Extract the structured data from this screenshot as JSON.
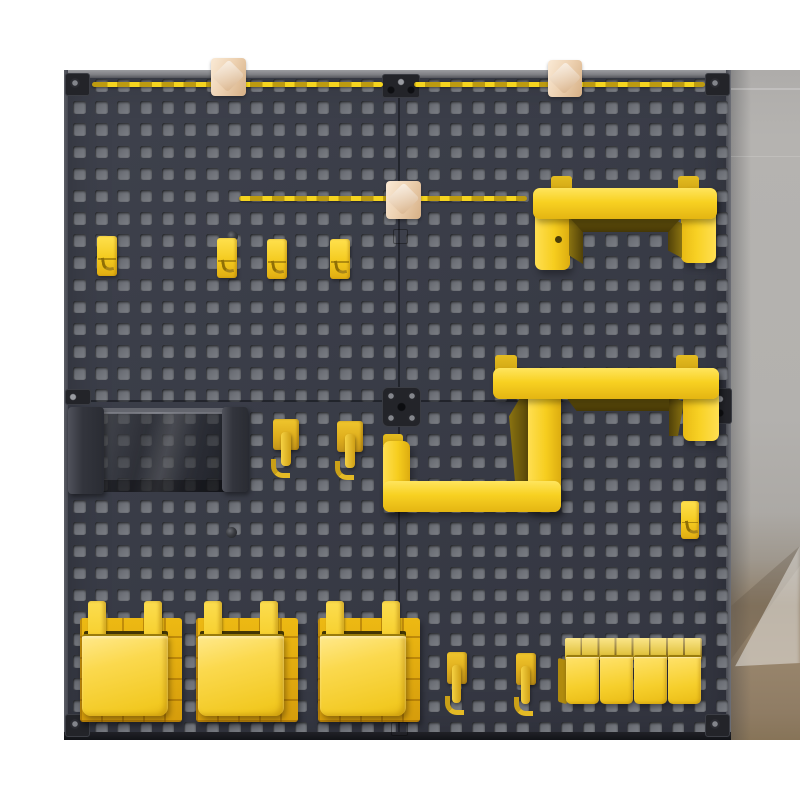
{
  "scene": {
    "title": "Dark square-hole pegboard wall organizer fitted with yellow accessories, photographed against a white backdrop with a grey wall and wooden floor visible on the right",
    "background_colors": {
      "backdrop": "#ffffff",
      "wall": "#b3b1ae",
      "floor": "#8f7c64"
    }
  },
  "pegboard": {
    "panels": "2x2 panels joined with black connector plates",
    "board_color": "#393c47",
    "hole_color": "#70737a",
    "edge_color": "#8c8d92",
    "grid": {
      "rows": 30,
      "cols": 30,
      "pitch": 22.17,
      "hole_size": 12.5,
      "offset_x": 9,
      "offset_y": 9
    }
  },
  "accessories": {
    "top_rails": {
      "count": 2,
      "color": "#f5d41f"
    },
    "middle_rail": {
      "count": 1,
      "color": "#f5d41f"
    },
    "wooden_clips": {
      "count": 3,
      "color": "#edd1b1"
    },
    "small_flat_hooks": {
      "count": 5,
      "color": "#f4ca1f"
    },
    "gold_j_hooks_middle": {
      "count": 2,
      "color": "#dfae1d"
    },
    "j_hooks_bottom": {
      "count": 2,
      "color": "#dfae1d"
    },
    "u_shelf_bracket_top_right": {
      "count": 1,
      "color": "#f8d122"
    },
    "zigzag_shelf_bracket_middle": {
      "count": 1,
      "color": "#f8d122"
    },
    "smoked_acrylic_tray": {
      "count": 1,
      "color": "rgba(20,22,27,0.52)"
    },
    "large_storage_bins": {
      "count": 3,
      "color": "#fbd94e",
      "backing_color": "#e3ab10"
    },
    "mini_parts_bins": {
      "count": 4,
      "color": "#f6cf2c"
    },
    "corner_plates": {
      "count": 4,
      "color": "#232429"
    },
    "seam_connector_plates": {
      "count": 4,
      "color": "#232429"
    }
  }
}
